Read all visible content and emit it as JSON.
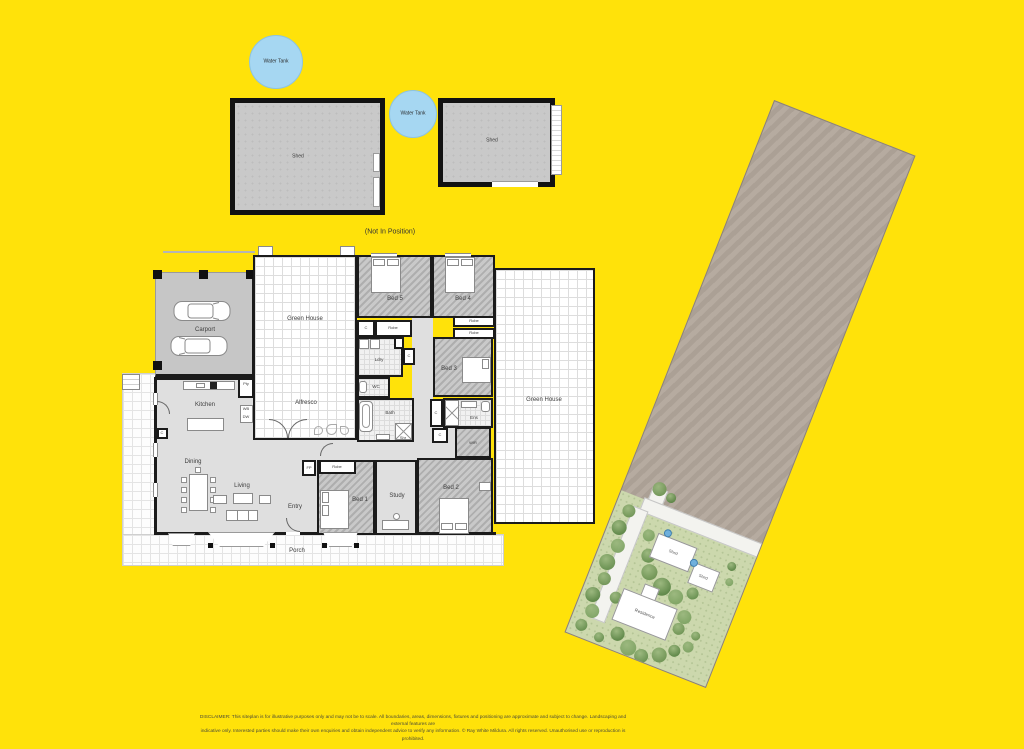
{
  "page": {
    "background": "#ffe20a"
  },
  "top_section": {
    "water_tank_1": "Water Tank",
    "water_tank_2": "Water Tank",
    "shed_left": "Shed",
    "shed_right": "Shed",
    "note": "(Not In Position)"
  },
  "floorplan": {
    "rooms": {
      "carport": "Carport",
      "green_house": "Green House",
      "alfresco": "Alfresco",
      "green_house_right": "Green House",
      "kitchen": "Kitchen",
      "dining": "Dining",
      "living": "Living",
      "entry": "Entry",
      "porch": "Porch",
      "bed1": "Bed 1",
      "bed2": "Bed 2",
      "bed3": "Bed 3",
      "bed4": "Bed 4",
      "bed5": "Bed 5",
      "study": "Study",
      "bath": "Bath",
      "ens": "Ens",
      "wc": "WC",
      "ldry": "Ldry",
      "wir": "WIR"
    },
    "abbr": {
      "c": "C",
      "robe": "Robe",
      "fp": "FP",
      "pty": "Pty",
      "shr": "Shr",
      "wb": "WB",
      "dw": "DW"
    }
  },
  "siteplan": {
    "residence": "Residence",
    "shed_a": "Shed",
    "shed_b": "Shed"
  },
  "disclaimer": {
    "line1": "DISCLAIMER: This siteplan is for illustrative purposes only and may not be to scale. All boundaries, areas, dimensions, fixtures and positioning are approximate and subject to change. Landscaping and external features are",
    "line2": "indicative only. Interested parties should make their own enquiries and obtain independent advice to verify any information. © Ray White Mildura. All rights reserved. Unauthorised use or reproduction is prohibited."
  },
  "colors": {
    "background": "#ffe20a",
    "water_tank": "#a6d7f2",
    "shed_fill": "#c9c9c9",
    "floor": "#dfdfdf",
    "wall": "#1b1b1b",
    "dirt": "#b2a79b",
    "lawn": "#ccd8ad",
    "tree": "#6a8f53",
    "road": "#f3f3ef"
  }
}
